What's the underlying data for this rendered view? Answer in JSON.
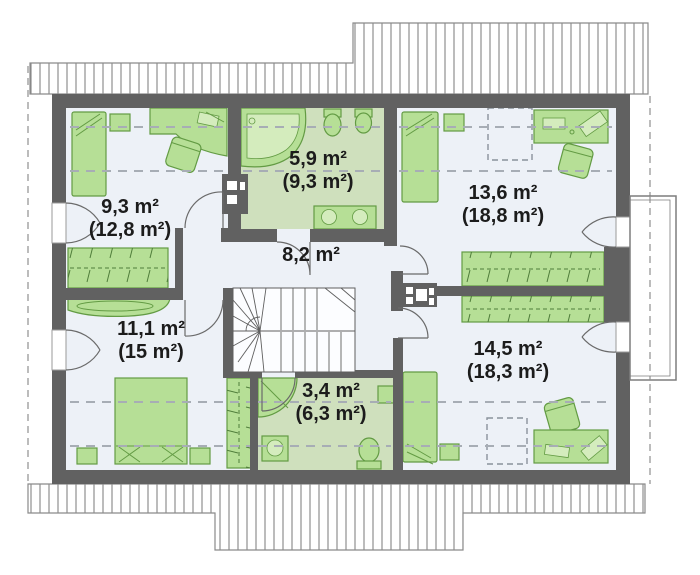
{
  "plan": {
    "type": "attic floor plan",
    "rooms": [
      {
        "name": "bedroom-top-left",
        "area": "9,3 m²",
        "area_gross": "(12,8 m²)"
      },
      {
        "name": "bathroom-top",
        "area": "5,9 m²",
        "area_gross": "(9,3 m²)"
      },
      {
        "name": "bedroom-top-right",
        "area": "13,6 m²",
        "area_gross": "(18,8 m²)"
      },
      {
        "name": "hall",
        "area": "8,2 m²",
        "area_gross": ""
      },
      {
        "name": "bedroom-bottom-left",
        "area": "11,1 m²",
        "area_gross": "(15 m²)"
      },
      {
        "name": "bedroom-bottom-right",
        "area": "14,5 m²",
        "area_gross": "(18,3 m²)"
      },
      {
        "name": "bathroom-bottom",
        "area": "3,4 m²",
        "area_gross": "(6,3 m²)"
      }
    ],
    "colors": {
      "wall": "#616161",
      "floor": "#edf1f7",
      "bath_floor": "#cfe0bd",
      "furniture": "#b6df96",
      "furniture_stroke": "#639b44",
      "fixture_inner": "#d4ecbd",
      "dash": "#a7adb5",
      "text": "#1c1c1c"
    }
  }
}
